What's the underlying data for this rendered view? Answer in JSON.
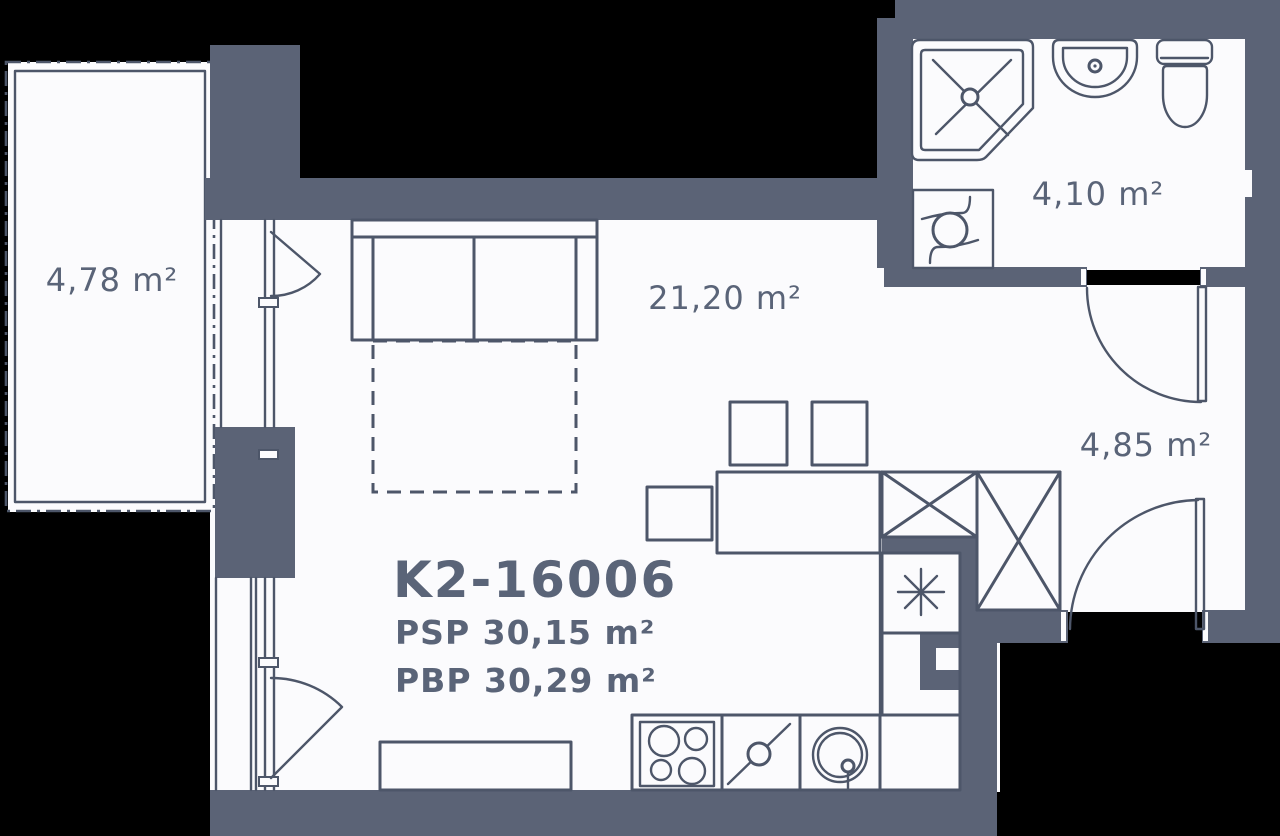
{
  "plan": {
    "unit_id": "K2-16006",
    "psp": "PSP 30,15 m²",
    "pbp": "PBP 30,29 m²",
    "rooms": {
      "balcony": "4,78 m²",
      "living_room": "21,20 m²",
      "bathroom": "4,10 m²",
      "hallway": "4,85 m²"
    }
  },
  "colors": {
    "background": "#000000",
    "wall": "#5b6376",
    "line": "#4d5669",
    "floor": "#fbfbfd",
    "text": "#5a6478"
  }
}
